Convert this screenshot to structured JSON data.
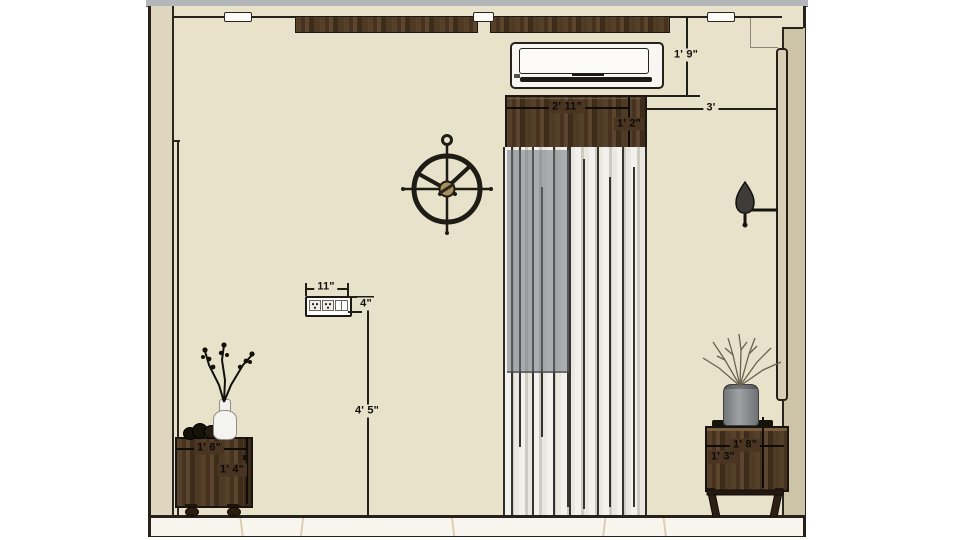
{
  "drawing": {
    "type": "interior wall elevation",
    "dims": {
      "ac_above_pelmet": "1' 9\"",
      "pelmet_to_side_wall": "3'",
      "pelmet_width": "2' 11\"",
      "pelmet_height": "1' 2\"",
      "outlet_width": "11\"",
      "outlet_height": "4\"",
      "outlet_from_floor": "4' 5\"",
      "left_table_width": "1' 6\"",
      "left_table_height": "1' 4\"",
      "right_table_width": "1' 8\"",
      "right_table_height": "1' 3\""
    },
    "objects": {
      "ac_unit": "split air conditioner",
      "pelmet": "wooden curtain pelmet",
      "curtain": "sheer floor-length curtain over window",
      "clock": "round metal wall clock",
      "sconce": "wall sconce lamp",
      "outlet": "electrical socket plate",
      "left_table": "wooden chest side table with bottle vase and dry branches",
      "right_table": "wooden side table with gray vase and dry twigs",
      "ceiling_trim": "dark wood ceiling trim strips",
      "floor": "white marble floor"
    },
    "colors": {
      "wall": "#e9e2cb",
      "wood_dark": "#4a3523",
      "pillar_left": "#ded6bf",
      "pillar_right": "#cdc3a6",
      "panel": "#d8cfb6",
      "marble": "#f8f5ef",
      "outline": "#26211b",
      "top_strip": "#b4b7ba",
      "curtain": "#e6e3db",
      "window_glass": "#6d737b",
      "clock_center": "#a8905e"
    }
  }
}
